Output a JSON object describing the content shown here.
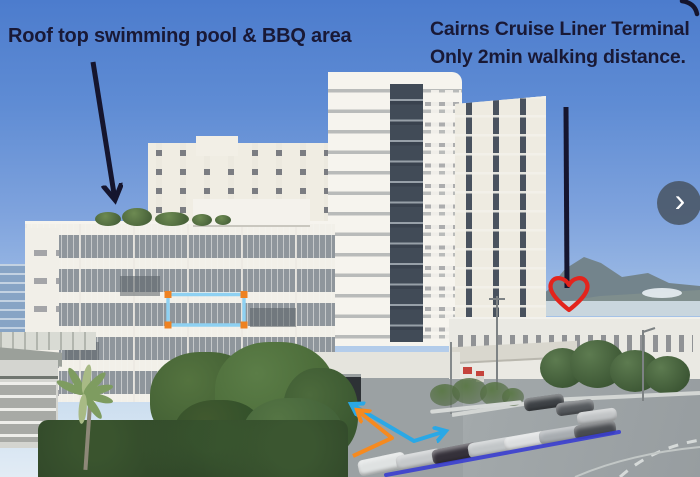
{
  "photo_labels": {
    "pool": "Roof top swimming pool & BBQ area",
    "terminal_line1": "Cairns Cruise Liner Terminal",
    "terminal_line2": "Only 2min walking distance."
  },
  "carousel": {
    "next_icon": "›"
  },
  "colors": {
    "label_text": "#191936",
    "pointer_stroke": "#15152e",
    "heart_red": "#e3241c",
    "selection_blue": "#8ed1f2",
    "handle_orange": "#ee8222",
    "arrow_cyan": "#2aa8e6",
    "arrow_orange": "#f68a1f",
    "route_blue": "#3a3ed0"
  }
}
